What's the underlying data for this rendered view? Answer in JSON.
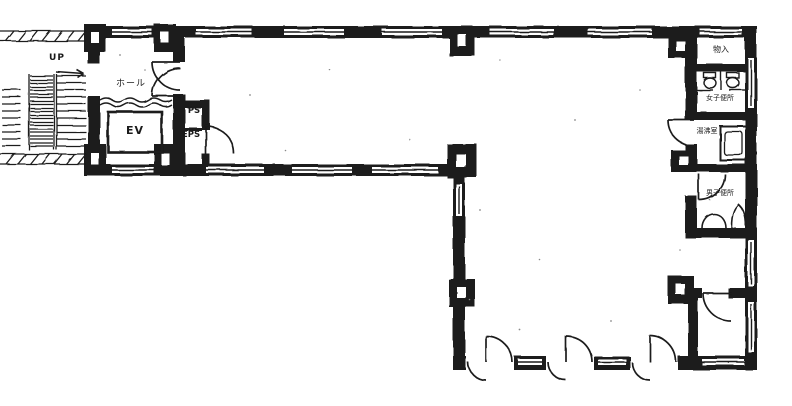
{
  "app": {
    "type": "architectural-floor-plan",
    "shape": "L-shaped office floor"
  },
  "colors": {
    "ink": "#1a1a1a",
    "paper": "#ffffff"
  },
  "labels": {
    "stairs_up": "UP",
    "hall": "ホール",
    "elevator": "EV",
    "pipe_shaft": "PS",
    "electric_pipe_shaft": "EPS",
    "storage": "物入",
    "womens_toilet": "女子便所",
    "kitchenette": "湯沸室",
    "mens_toilet": "男子便所"
  }
}
